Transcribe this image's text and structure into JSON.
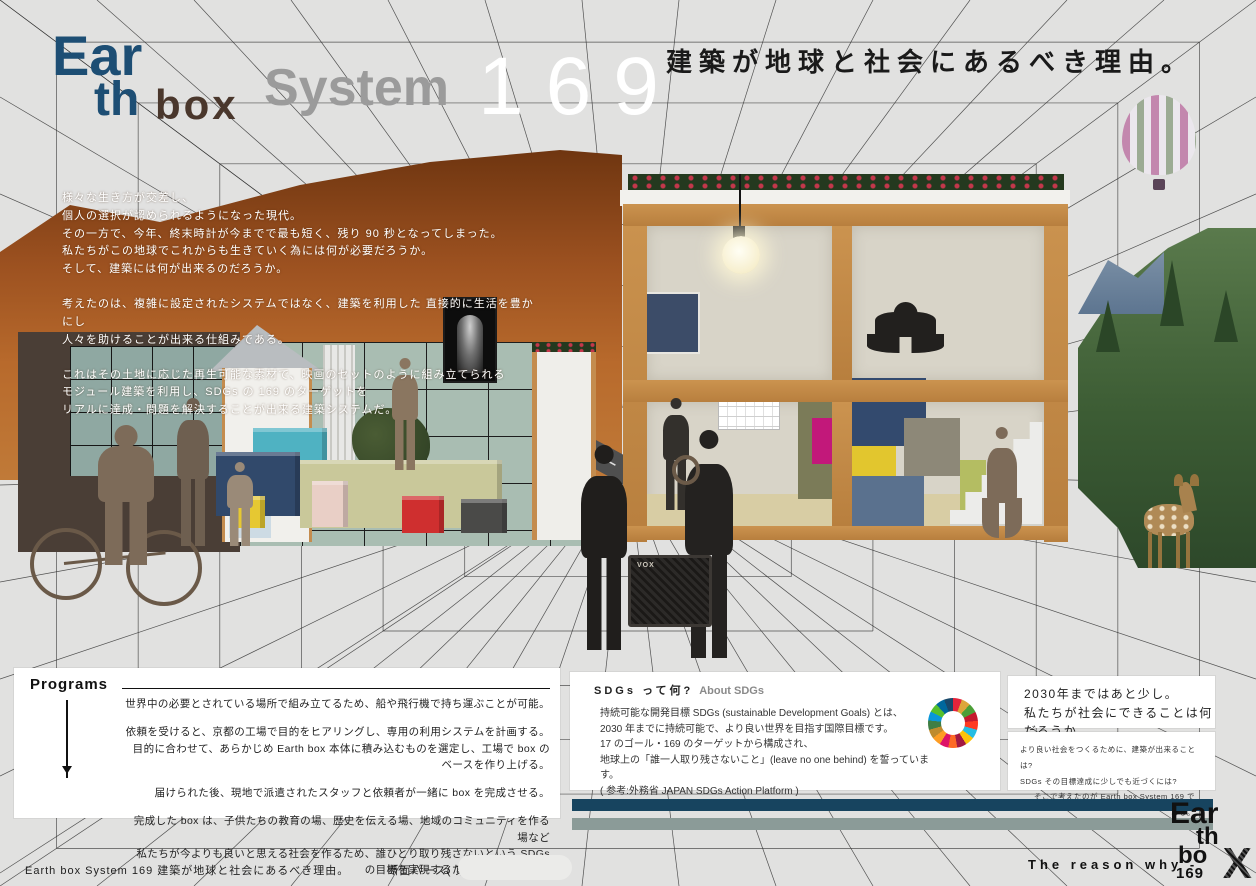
{
  "logo": {
    "line1": "Ear",
    "line2": "th",
    "word_box": "box",
    "word_system": "System",
    "number": "169"
  },
  "title": "建築が地球と社会にあるべき理由。",
  "intro": {
    "lines": [
      "様々な生き方が交差し、",
      "個人の選択が認められるようになった現代。",
      "その一方で、今年、終末時計が今までで最も短く、残り 90 秒となってしまった。",
      "私たちがこの地球でこれからも生きていく為には何が必要だろうか。",
      "そして、建築には何が出来るのだろうか。",
      "考えたのは、複雑に設定されたシステムではなく、建築を利用した 直接的に生活を豊かにし",
      "人々を助けることが出来る仕組みである。",
      "これはその土地に応じた再生可能な素材で、映画のセットのように組み立てられる",
      "モジュール建築を利用し、SDGs の 169 のターゲットを",
      "リアルに達成・問題を解決することが出来る建築システムだ。"
    ]
  },
  "programs": {
    "heading": "Programs",
    "lines": [
      "世界中の必要とされている場所で組み立てるため、船や飛行機で持ち運ぶことが可能。",
      "依頼を受けると、京都の工場で目的をヒアリングし、専用の利用システムを計画する。",
      "目的に合わせて、あらかじめ Earth box 本体に積み込むものを選定し、工場で box のベースを作り上げる。",
      "届けられた後、現地で派遣されたスタッフと依頼者が一緒に box を完成させる。",
      "完成した box は、子供たちの教育の場、歴史を伝える場、地域のコミュニティを作る場など",
      "私たちが今よりも良いと思える社会を作るため、誰ひとり取り残さないという SDGs の目標を実現するために使用される。"
    ]
  },
  "sdgs": {
    "heading": "SDGs って何?",
    "subheading": "About SDGs",
    "lines": [
      "持続可能な開発目標 SDGs (sustainable Development Goals) とは、",
      "2030 年までに持続可能で、より良い世界を目指す国際目標です。",
      "17 のゴール・169 のターゲットから構成され、",
      "地球上の「誰一人取り残さないこと」(leave no one behind) を誓っています。",
      "( 参考:外務省 JAPAN SDGs Action Platform )"
    ]
  },
  "aside": {
    "box1_lines": [
      "2030年まではあと少し。",
      "私たちが社会にできることは何だろうか。"
    ],
    "box2_lines": [
      "より良い社会をつくるために、建築が出来ることは?",
      "SDGs その目標達成に少しでも近づくには?",
      "そこで考えたのが Earth box System 169 である。"
    ]
  },
  "footer": {
    "left": "Earth box System 169  建築が地球と社会にあるべき理由。",
    "caption": "断面パース( 東側内観パース )",
    "reason": "The reason why -"
  },
  "footer_logo": {
    "line1": "Ear",
    "line2": "th",
    "line3": "bo",
    "x": "X",
    "number": "169"
  },
  "scene": {
    "amp_label": "VOX"
  },
  "colors": {
    "logo_blue": "#1d4e74",
    "logo_brown": "#4a372c",
    "logo_gray": "#9b9b9b",
    "bar_blue": "#17445f",
    "bar_gray": "#8b9b98",
    "wood": "#c48c4e",
    "wall": "#d8d4c8",
    "desert": "#b86a2c",
    "forest": "#3c5c34"
  }
}
